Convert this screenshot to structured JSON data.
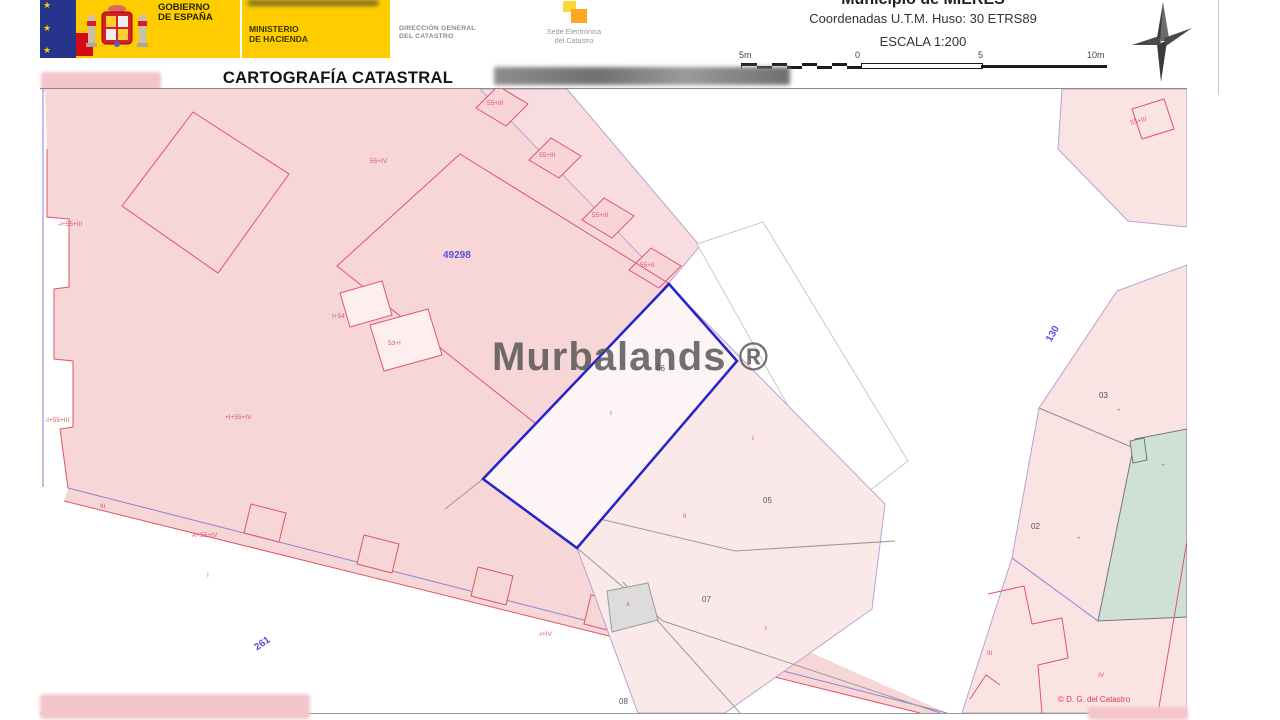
{
  "header": {
    "gobierno_l1": "GOBIERNO",
    "gobierno_l2": "DE ESPAÑA",
    "ministerio_l1": "MINISTERIO",
    "ministerio_l2": "DE HACIENDA",
    "direccion_l1": "DIRECCIÓN GENERAL",
    "direccion_l2": "DEL CATASTRO",
    "sede_l1": "Sede Electrónica",
    "sede_l2": "del Catastro",
    "municipio": "Municipio de MIERES",
    "coordenadas": "Coordenadas U.T.M. Huso: 30 ETRS89",
    "escala": "ESCALA 1:200",
    "title": "CARTOGRAFÍA CATASTRAL",
    "scalebar": {
      "l0": "5m",
      "l1": "0",
      "l2": "5",
      "l3": "10m"
    }
  },
  "map": {
    "watermark": "Murbalands ®",
    "copyright": "© D. G. del Catastro",
    "labels": [
      {
        "t": "55+IV",
        "x": 330,
        "y": 70,
        "c": "lr"
      },
      {
        "t": "-I+55+III",
        "x": 18,
        "y": 133,
        "c": "lr"
      },
      {
        "t": "55+III",
        "x": 447,
        "y": 12,
        "c": "lr"
      },
      {
        "t": "55+III",
        "x": 499,
        "y": 64,
        "c": "lr"
      },
      {
        "t": "55+III",
        "x": 552,
        "y": 124,
        "c": "lr"
      },
      {
        "t": "55+II",
        "x": 600,
        "y": 174,
        "c": "lr"
      },
      {
        "t": "I+54",
        "x": 292,
        "y": 225,
        "c": "lr"
      },
      {
        "t": "53+I",
        "x": 348,
        "y": 252,
        "c": "lr"
      },
      {
        "t": "+I+55+IV",
        "x": 185,
        "y": 326,
        "c": "lr"
      },
      {
        "t": "-I+55+III",
        "x": 5,
        "y": 329,
        "c": "lr"
      },
      {
        "t": "III",
        "x": 60,
        "y": 415,
        "c": "lr"
      },
      {
        "t": "A+55+IV",
        "x": 152,
        "y": 444,
        "c": "lr"
      },
      {
        "t": "I",
        "x": 167,
        "y": 484,
        "c": "lr"
      },
      {
        "t": "I",
        "x": 570,
        "y": 322,
        "c": "lr"
      },
      {
        "t": "I",
        "x": 712,
        "y": 347,
        "c": "lr"
      },
      {
        "t": "II",
        "x": 643,
        "y": 425,
        "c": "lr"
      },
      {
        "t": "I",
        "x": 725,
        "y": 537,
        "c": "lr"
      },
      {
        "t": "-I+IV",
        "x": 498,
        "y": 543,
        "c": "lr"
      },
      {
        "t": "A",
        "x": 586,
        "y": 514,
        "c": "lr",
        "s": 5.5
      },
      {
        "t": "+",
        "x": 1077,
        "y": 319,
        "c": "lr"
      },
      {
        "t": "+",
        "x": 1037,
        "y": 447,
        "c": "lr"
      },
      {
        "t": "+",
        "x": 1121,
        "y": 374,
        "c": "lr"
      },
      {
        "t": "III",
        "x": 947,
        "y": 562,
        "c": "lr"
      },
      {
        "t": "IV",
        "x": 1058,
        "y": 584,
        "c": "lr"
      },
      {
        "t": "55+III",
        "x": 1090,
        "y": 32,
        "c": "lr",
        "r": -15
      },
      {
        "t": "06",
        "x": 616,
        "y": 276,
        "c": "ld"
      },
      {
        "t": "05",
        "x": 723,
        "y": 408,
        "c": "ld"
      },
      {
        "t": "07",
        "x": 662,
        "y": 507,
        "c": "ld"
      },
      {
        "t": "08",
        "x": 579,
        "y": 609,
        "c": "ld"
      },
      {
        "t": "03",
        "x": 1059,
        "y": 303,
        "c": "ld"
      },
      {
        "t": "02",
        "x": 991,
        "y": 434,
        "c": "ld"
      },
      {
        "t": "49298",
        "x": 403,
        "y": 162,
        "c": "lb"
      },
      {
        "t": "261",
        "x": 213,
        "y": 556,
        "c": "lb",
        "r": -35
      },
      {
        "t": "130",
        "x": 1005,
        "y": 250,
        "c": "lb",
        "r": -60
      }
    ]
  },
  "colors": {
    "banner_yellow": "#ffcc00",
    "flag_navy": "#26348b",
    "flag_red": "#d20a11",
    "parcel_pink": "#f7d6d8",
    "parcel_pink_light": "#fbe9e9",
    "highlight_blue": "#2424cc",
    "boundary_purple": "#b7a3d6",
    "teal": "#cfe0d6",
    "label_red": "#e0566a",
    "label_blue": "#5a4fd8"
  }
}
